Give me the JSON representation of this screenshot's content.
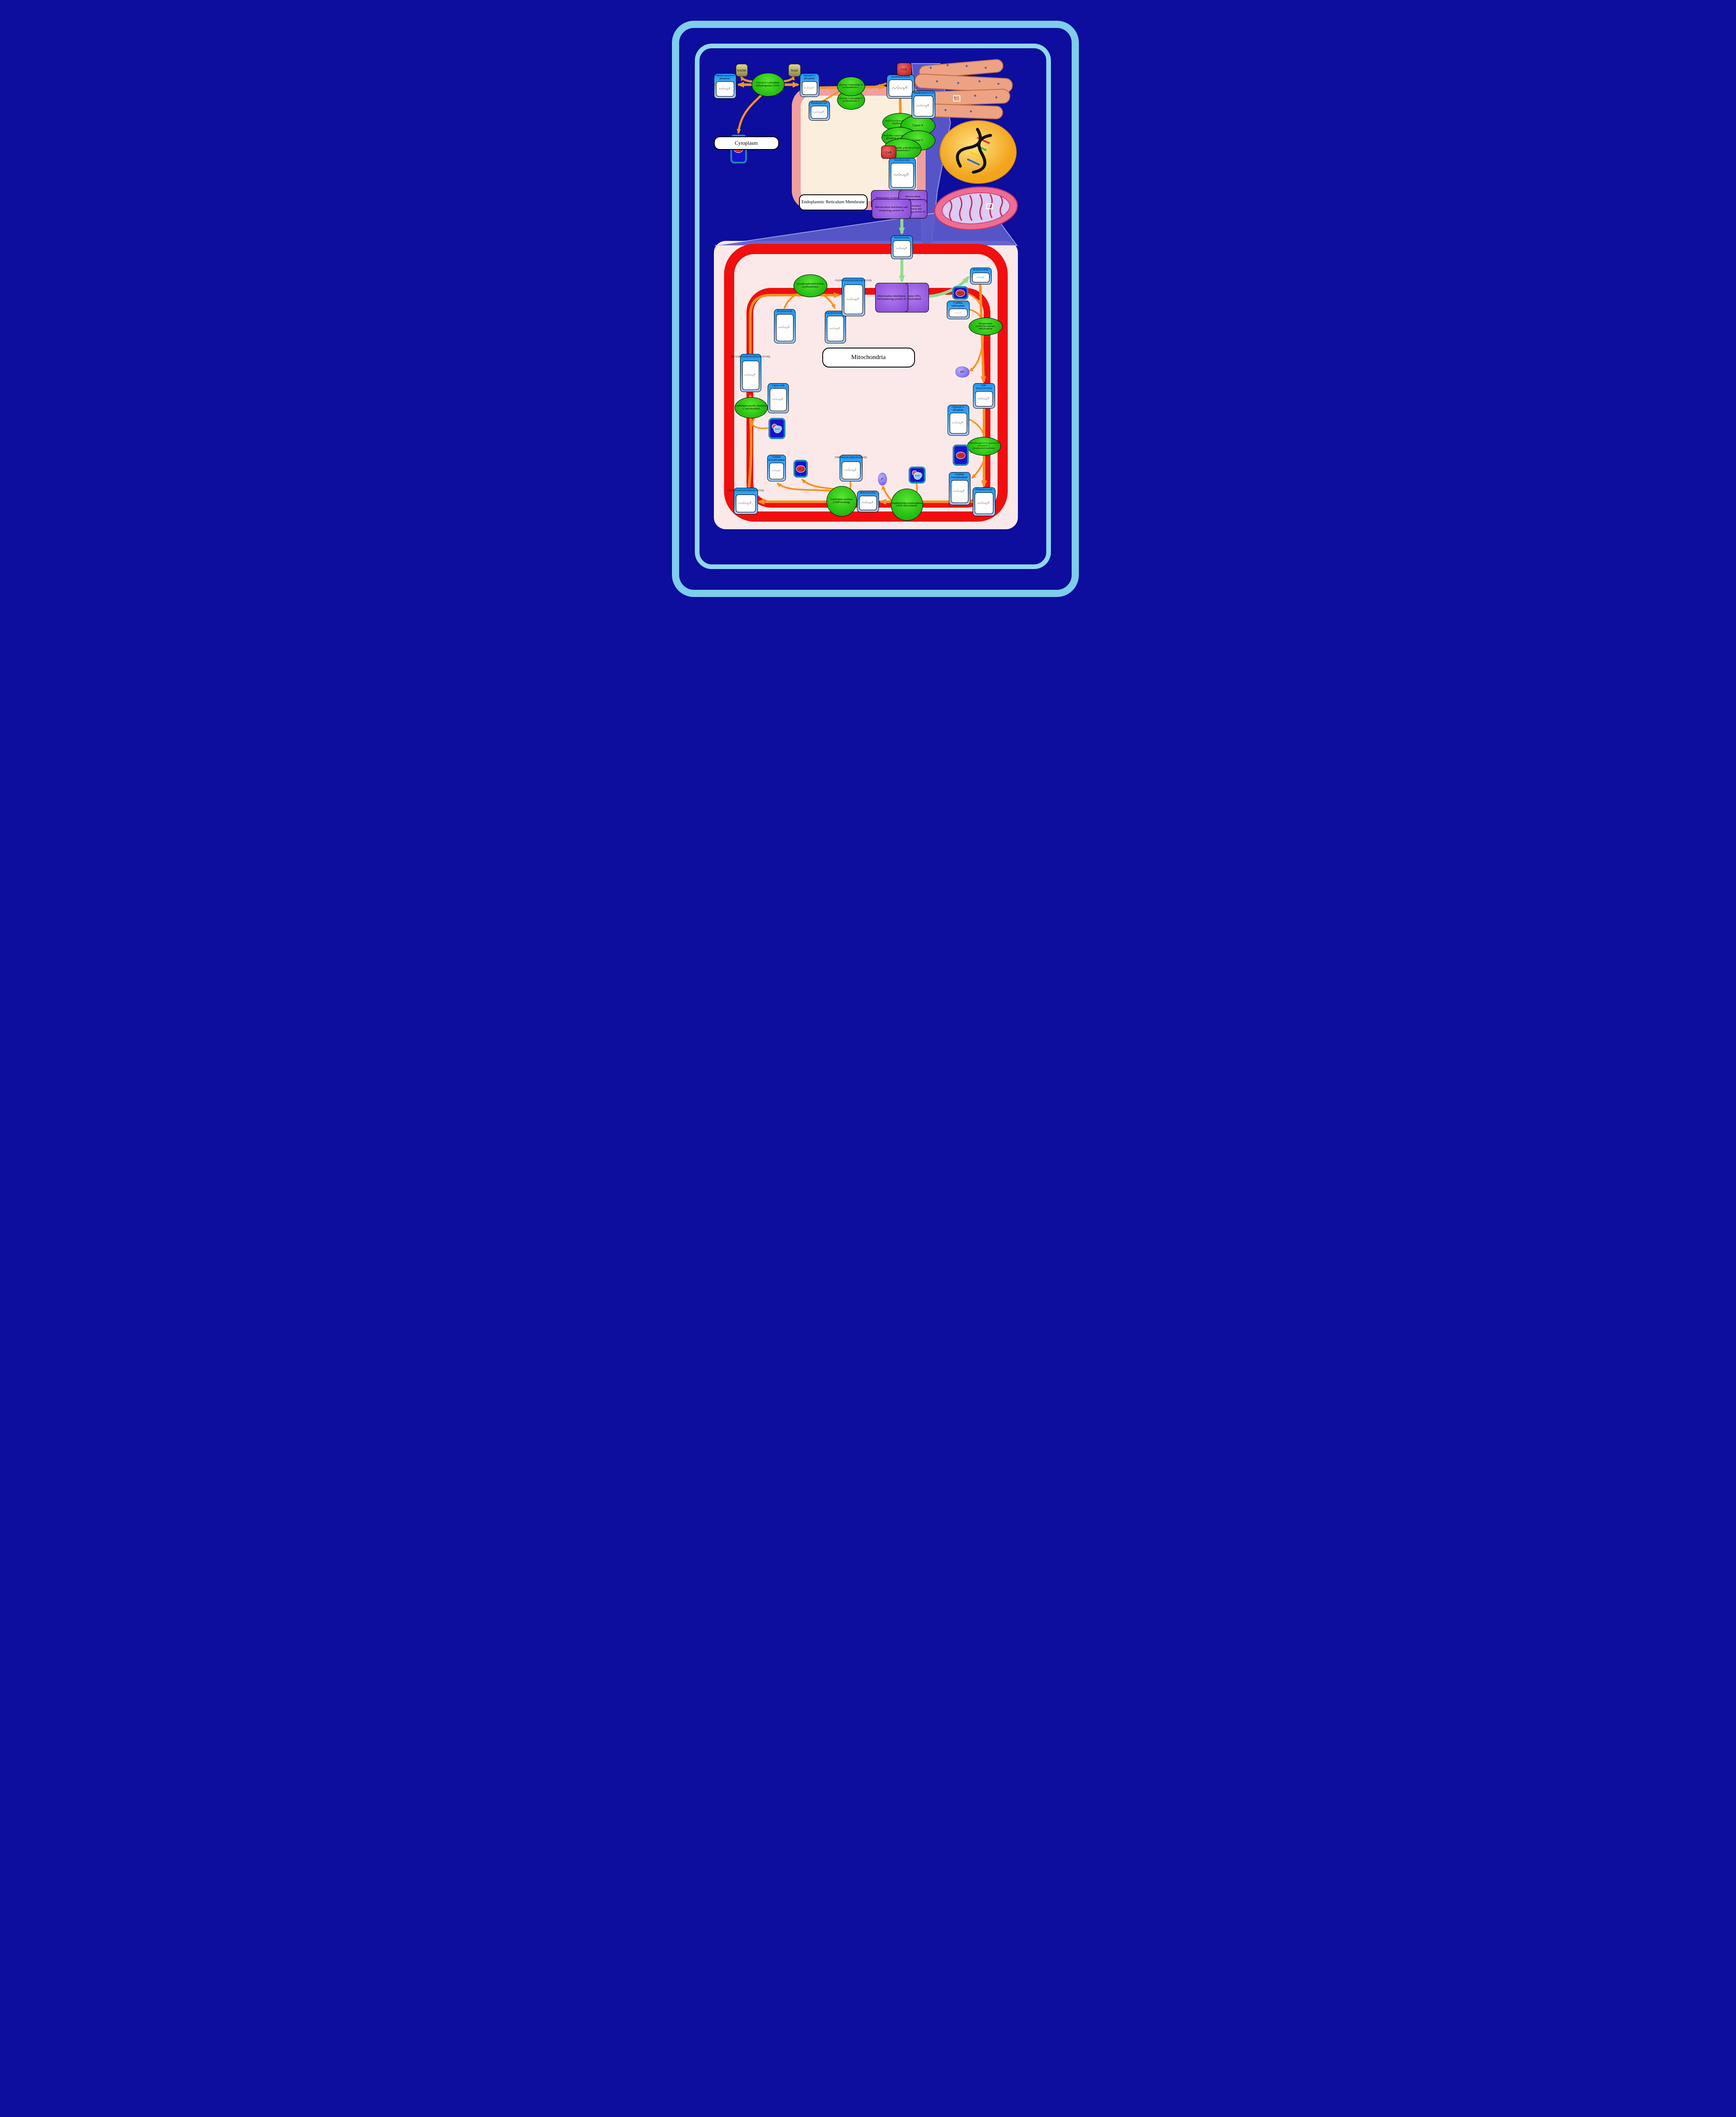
{
  "compartments": {
    "cytoplasm": "Cytoplasm",
    "er": "Endoplasmic Reticulum Membrane",
    "mitochondria": "Mitochondria"
  },
  "nodes": {
    "dhap": "Dihydroxyacetone phosphate",
    "g3p": "Glycerol 3-phosphate",
    "decanoyl_coa": "Decanoyl-CoA",
    "lysopa": "LysoPA(10:0/0:0)",
    "tetradecanoyl_coa": "Tetradecanoyl-CoA",
    "pa_er": "PA(10:0/14:0)",
    "pa_mid": "PA(10:0/14:0)",
    "pa_right": "PA(10:0/14:0)",
    "ctp": "Cytidine triphosphate",
    "cdp_dg1": "CDP-DG(10:0/14:0)",
    "g3p_right": "Glycerol 3-phosphate",
    "cmp_right": "Cytidine monophosphate",
    "pgp": "PGP(10:0/14:0)",
    "pg": "PG(10:0/14:0)",
    "cdp_dg2": "CDP-DG(18:1(9Z)/20:1(11Z))",
    "cmp_left": "Cytidine monophosphate",
    "cl_bottom": "CL(10:0/14:0/18:1(9Z)/20:1(11Z))",
    "mlcl": "MLCL(0:0/14:0/18:1(9Z)/20:1(11Z))",
    "capric": "Capric acid",
    "pc": "PC(10:0/10:0)",
    "lysopc": "LysoPC(10:0/0:0)",
    "cl_top": "CL(10:0/14:0/18:1(9Z)/20:1(11Z))"
  },
  "small": {
    "nadh": "NADH",
    "nad": "NAD",
    "coa": "CoA",
    "h": "H",
    "h_sup": "+",
    "h2o_h": "H",
    "h2o_sub": "2",
    "h2o_o": "O",
    "ppi_main": "PP",
    "ppi_sub": "i",
    "pi_main": "P",
    "pi_sub": "i"
  },
  "enzymes": {
    "gpd2": "Glycerol-3-phosphate dehydrogenase GPD2",
    "gpat1": "Glycerol-3-phosphate O-acyltransferase 1",
    "gpat2": "Glycerol-3-phosphate O-acyltransferase 2",
    "acyl_lyso": "Acyl-CoA:lyso-phospholipid acyltransferase",
    "lipase4": "Lipase 4",
    "probable_agpat": "Probable 1-acyl-sn-glycerol-3-phosphate acyltransferase",
    "lipase5": "Lipase 5",
    "lpaat1": "Lysophosphatidic acid:oleoyl-CoA acyltransferase 1",
    "lpcat": "Lysophosphatidylcholine acyltransferase",
    "pcyt": "Phosphatidate cytidylyltransferase, mitochondrial",
    "cdppt": "CDP-diacylglycerol--glycerol-3-phosphate 3-phosphatidyltransferase",
    "gep4": "Phosphatidylglycerophosphatase GEP4, mitochondrial",
    "clsyn": "Cardiolipin synthase (CMP-forming)",
    "cld1": "Cardiolipin-specific deacylase 1, mitochondrial"
  },
  "proteins": {
    "b1": "Maintenance of mitochondrial morphology",
    "b2": "Mitochondrial distribution and morphology",
    "b3": "Mitochondrial distribution and morphology protein 34",
    "b4": "Mitochondrial distribution and morphology protein 10",
    "b5": "Mitochondrial distribution and morphology protein 35",
    "b6": "Protein UPS1, mitochondrial"
  },
  "colors": {
    "background_navy": "#0d0d9e",
    "cell_membrane_blue": "#7ecdec",
    "er_membrane_salmon": "#ef9f9f",
    "er_lumen_cream": "#fceedd",
    "mito_membrane_red": "#f10e0e",
    "mito_matrix_pink": "#fbe9e9",
    "zoom_cone_slate": "#5b5bcb",
    "arrow_orange": "#f6921e",
    "arrow_green": "#90dd90",
    "enzyme_green": "#2cc414",
    "protein_purple": "#9a5ce0",
    "node_blue": "#2196f3"
  }
}
